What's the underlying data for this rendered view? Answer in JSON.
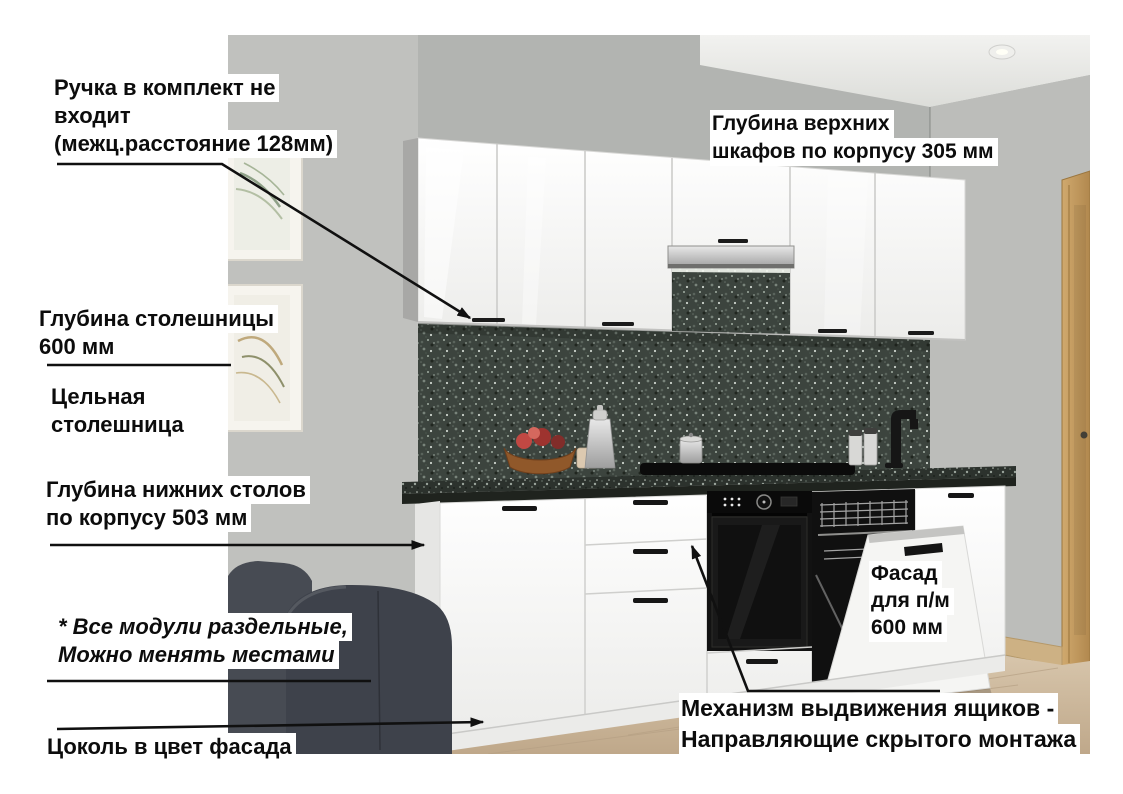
{
  "annotations": {
    "handle_note": {
      "lines": [
        "Ручка в комплект не",
        "входит",
        "(межц.расстояние 128мм)"
      ]
    },
    "upper_cabinet_depth": {
      "lines": [
        "Глубина верхних",
        "шкафов по корпусу 305 мм"
      ]
    },
    "countertop_depth": {
      "lines": [
        "Глубина столешницы",
        "600 мм"
      ]
    },
    "solid_countertop": {
      "lines": [
        "Цельная",
        "столешница"
      ]
    },
    "base_cabinet_depth": {
      "lines": [
        "Глубина нижних столов",
        "по корпусу 503 мм"
      ]
    },
    "modules_note": {
      "lines": [
        "* Все модули раздельные,",
        "Можно менять местами"
      ]
    },
    "plinth_note": {
      "lines": [
        "Цоколь в цвет фасада"
      ]
    },
    "dishwasher_facade": {
      "lines": [
        "Фасад",
        "для п/м",
        "600 мм"
      ]
    },
    "drawer_mechanism": {
      "lines": [
        "Механизм выдвижения ящиков -",
        "Направляющие скрытого монтажа"
      ]
    }
  },
  "scene": {
    "description": "3D render of a white glossy straight kitchen in a gray room",
    "objects": [
      "upper-cabinets",
      "cooker-hood",
      "speckled-backsplash",
      "dark-countertop",
      "base-cabinets",
      "built-in-oven",
      "open-dishwasher",
      "fruit-bowl",
      "cocktail-shaker",
      "pot-on-hob",
      "canisters",
      "black-faucet",
      "wall-pictures",
      "dark-sofa",
      "ceiling-spotlight",
      "wooden-door",
      "wood-floor"
    ],
    "colors": {
      "wall": "#b2b4b1",
      "ceiling": "#e9eae7",
      "cabinets": "#f6f6f4",
      "backsplash": "#3c443e",
      "countertop": "#2c322d",
      "oven": "#121212",
      "floor": "#cdb998",
      "door_wood": "#c29a5d",
      "sofa": "#41454d",
      "annotation_text": "#0c0c0c",
      "annotation_bg": "#ffffff",
      "arrow": "#101010"
    }
  }
}
